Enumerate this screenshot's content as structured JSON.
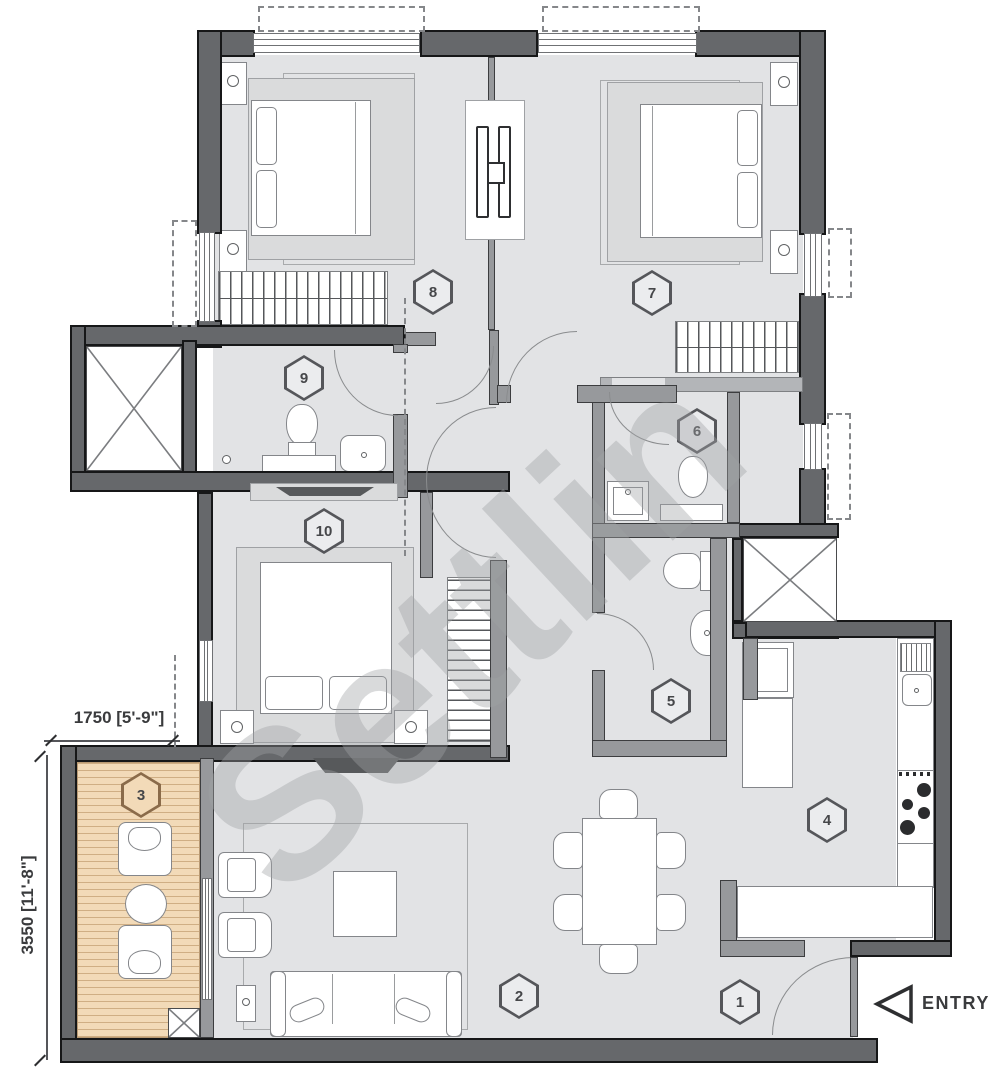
{
  "plan": {
    "type": "apartment-floor-plan",
    "watermark": "Settlin",
    "entry": {
      "label": "ENTRY"
    },
    "dimensions": {
      "balcony_width": "1750 [5'-9\"]",
      "balcony_depth": "3550 [11'-8\"]"
    },
    "rooms": [
      {
        "number": "1",
        "type": "foyer"
      },
      {
        "number": "2",
        "type": "living-dining"
      },
      {
        "number": "3",
        "type": "balcony-deck"
      },
      {
        "number": "4",
        "type": "kitchen"
      },
      {
        "number": "5",
        "type": "bathroom"
      },
      {
        "number": "6",
        "type": "toilet"
      },
      {
        "number": "7",
        "type": "bedroom"
      },
      {
        "number": "8",
        "type": "bedroom"
      },
      {
        "number": "9",
        "type": "bathroom"
      },
      {
        "number": "10",
        "type": "bedroom"
      }
    ],
    "colors": {
      "wall_dark": "#66686b",
      "wall_mid": "#97999c",
      "wall_light": "#b3b5b8",
      "floor": "#e2e3e5",
      "deck": "#f2dab8",
      "deck_line": "#cfae84",
      "fixture_outline": "#84868a",
      "hex_outline": "#55565a",
      "hex_outline_balcony": "#8a6b4a",
      "text": "#3a3b3d",
      "watermark_gray": "#aaacae"
    },
    "icons": {
      "entry_arrow": "left-pointing-triangle"
    }
  }
}
